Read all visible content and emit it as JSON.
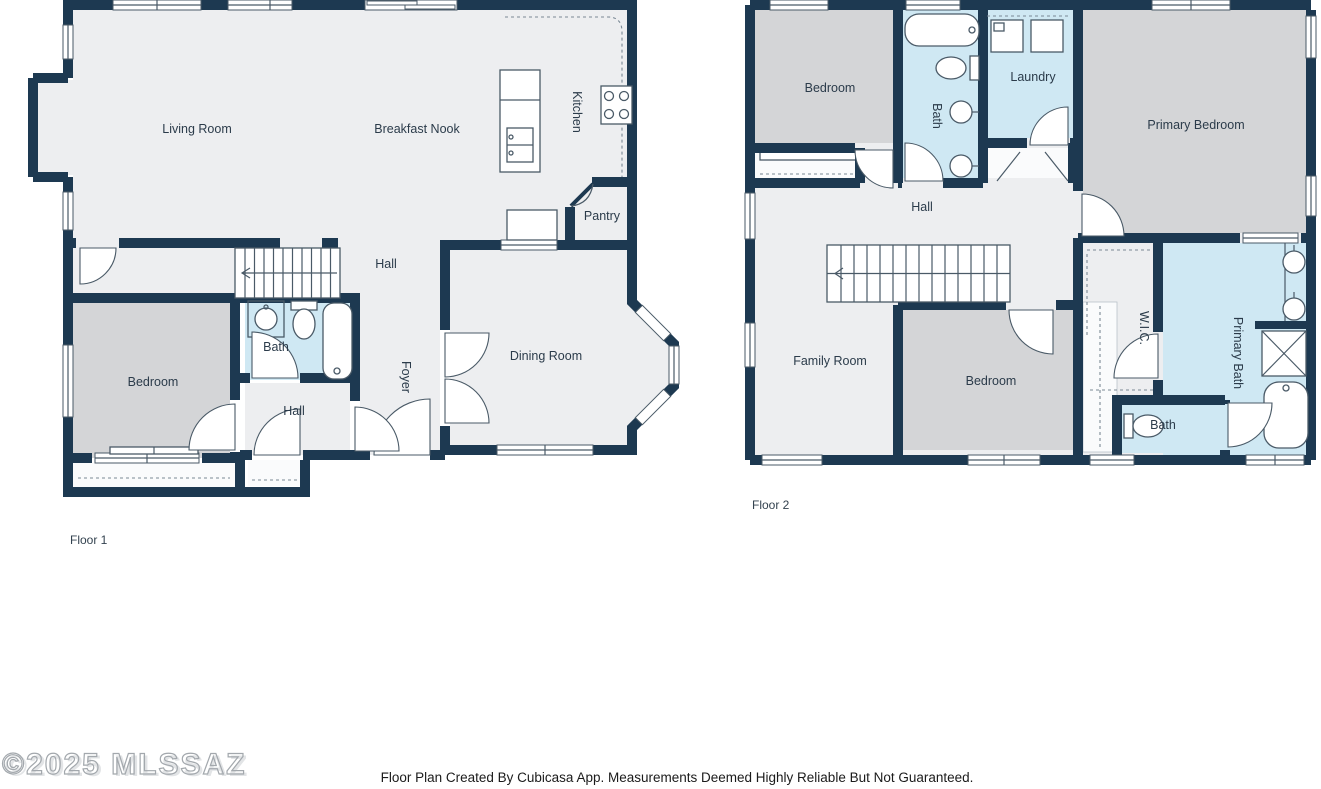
{
  "document": {
    "type": "floor-plan",
    "creator": "Cubicasa"
  },
  "floor1": {
    "label": "Floor 1",
    "rooms": {
      "living_room": "Living Room",
      "breakfast_nook": "Breakfast Nook",
      "kitchen": "Kitchen",
      "pantry": "Pantry",
      "hall": "Hall",
      "bedroom": "Bedroom",
      "bath": "Bath",
      "hall_lower": "Hall",
      "foyer": "Foyer",
      "dining_room": "Dining Room"
    },
    "fixtures": [
      "stairs",
      "kitchen-island",
      "double-sink",
      "stove",
      "counter",
      "bathtub",
      "toilet",
      "sink",
      "bay-window",
      "sliding-door",
      "door-arcs",
      "windows",
      "porch"
    ]
  },
  "floor2": {
    "label": "Floor 2",
    "rooms": {
      "bedroom_left": "Bedroom",
      "bath": "Bath",
      "laundry": "Laundry",
      "primary_bedroom": "Primary Bedroom",
      "hall": "Hall",
      "family_room": "Family Room",
      "bedroom_center": "Bedroom",
      "wic": "W.I.C.",
      "primary_bath": "Primary Bath",
      "bath_small": "Bath"
    },
    "fixtures": [
      "stairs",
      "bathtub",
      "toilet",
      "sinks",
      "washer",
      "dryer",
      "shower",
      "soaking-tub",
      "closets",
      "door-arcs",
      "windows"
    ]
  },
  "footer": {
    "disclaimer": "Floor Plan Created By Cubicasa App. Measurements Deemed Highly Reliable But Not Guaranteed."
  },
  "watermark": "©2025 MLSSAZ",
  "colors": {
    "wall": "#1d3951",
    "floor": "#edeef0",
    "bedroom": "#d4d5d7",
    "wet": "#cfe8f3",
    "label": "#2b3b4a"
  }
}
